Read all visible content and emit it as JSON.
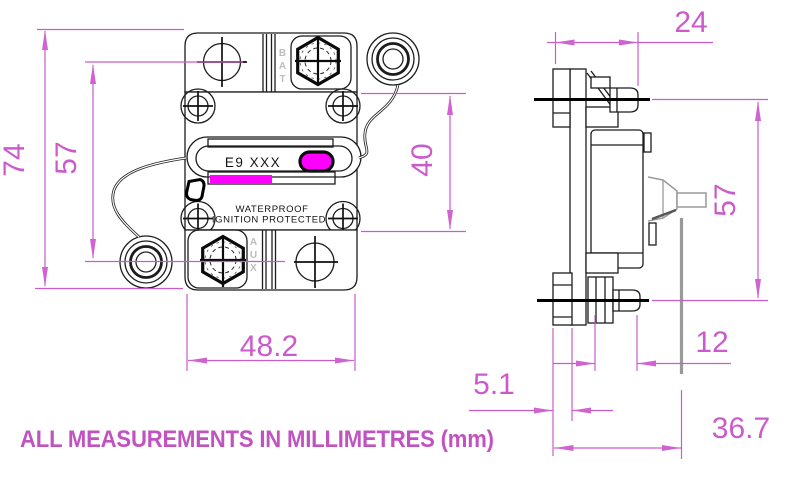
{
  "front_view": {
    "label": "E9 XXX",
    "marking_line1": "WATERPROOF",
    "marking_line2": "IGNITION PROTECTED",
    "terminal_top": "BAT",
    "terminal_bottom": "AUX",
    "dim_height": "74",
    "dim_hole_spacing": "57",
    "dim_width": "48.2",
    "dim_body_height": "40"
  },
  "side_view": {
    "dim_top_depth": "24",
    "dim_stud_spacing": "57",
    "dim_stud_length": "12",
    "dim_flange_thickness": "5.1",
    "dim_overall_depth": "36.7"
  },
  "footer": {
    "note": "ALL MEASUREMENTS IN MILLIMETRES (mm)"
  },
  "colors": {
    "dimension": "#cb5bcb",
    "accent_fill": "#ff00ff",
    "gray_part": "#9a9a9a"
  }
}
